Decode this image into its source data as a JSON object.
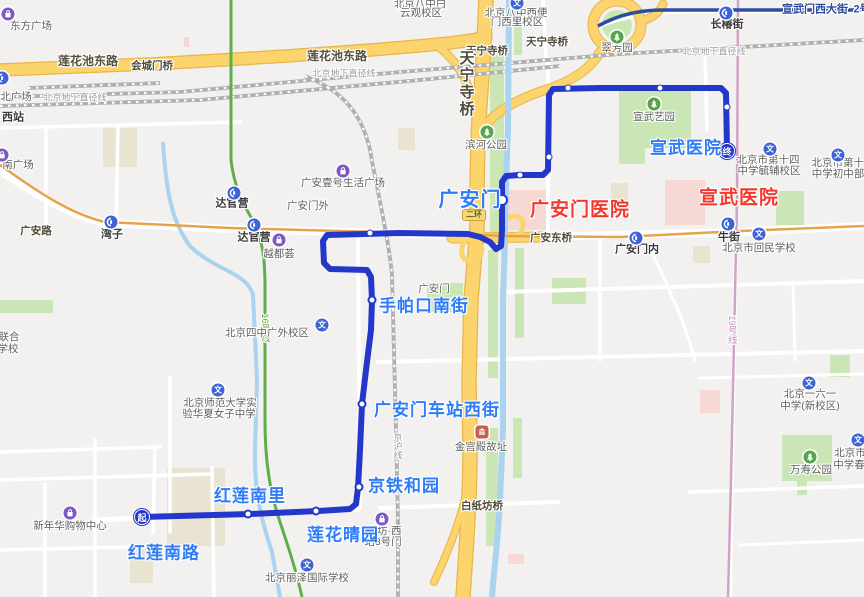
{
  "app": {
    "kind": "map-transit-route-view"
  },
  "colors": {
    "bg": "#f2f1ef",
    "route-blue": "#2337cb",
    "stop-blue": "#2e7cf6",
    "poi-red": "#f5382e",
    "road-yellow": "#fbd46d",
    "road-yellow-casing": "#e7b54a",
    "river-blue": "#a9d3ee",
    "park-green": "#c9e6b4",
    "metro-line2": "#2c4e9e",
    "metro-line7": "#e8a24c",
    "metro-line16": "#5fae49",
    "metro-line19": "#d0a2c6"
  },
  "route": {
    "start_badge": "起",
    "end_badge": "终",
    "points": [
      [
        142,
        517
      ],
      [
        250,
        514
      ],
      [
        318,
        511
      ],
      [
        350,
        509
      ],
      [
        356,
        504
      ],
      [
        358,
        488
      ],
      [
        360,
        450
      ],
      [
        362,
        404
      ],
      [
        366,
        370
      ],
      [
        371,
        330
      ],
      [
        372,
        300
      ],
      [
        371,
        277
      ],
      [
        367,
        270
      ],
      [
        330,
        269
      ],
      [
        324,
        263
      ],
      [
        323,
        241
      ],
      [
        327,
        235
      ],
      [
        400,
        233
      ],
      [
        468,
        234
      ],
      [
        480,
        237
      ],
      [
        490,
        242
      ],
      [
        496,
        249
      ],
      [
        501,
        246
      ],
      [
        502,
        230
      ],
      [
        502,
        182
      ],
      [
        506,
        176
      ],
      [
        519,
        175
      ],
      [
        543,
        175
      ],
      [
        548,
        170
      ],
      [
        549,
        95
      ],
      [
        553,
        89
      ],
      [
        600,
        88
      ],
      [
        660,
        88
      ],
      [
        721,
        88
      ],
      [
        726,
        93
      ],
      [
        727,
        150
      ]
    ],
    "stops": [
      {
        "name": "红莲南路",
        "kind": "start",
        "dot": [
          142,
          517
        ],
        "label": [
          164,
          553
        ]
      },
      {
        "name": "红莲南里",
        "kind": "mid",
        "dot": [
          248,
          514
        ],
        "label": [
          250,
          496
        ]
      },
      {
        "name": "莲花晴园",
        "kind": "mid",
        "dot": [
          316,
          511
        ],
        "label": [
          343,
          535
        ]
      },
      {
        "name": "京铁和园",
        "kind": "mid",
        "dot": [
          359,
          487
        ],
        "label": [
          404,
          486
        ]
      },
      {
        "name": "广安门车站西街",
        "kind": "mid",
        "dot": [
          362,
          404
        ],
        "label": [
          437,
          410
        ]
      },
      {
        "name": "手帕口南街",
        "kind": "mid",
        "dot": [
          372,
          300
        ],
        "label": [
          424,
          306
        ]
      },
      {
        "name": "广安门",
        "kind": "mid-big",
        "dot": [
          502,
          200
        ],
        "label": [
          470,
          200
        ]
      },
      {
        "name": "宣武医院",
        "kind": "end",
        "dot": [
          727,
          151
        ],
        "label": [
          686,
          148
        ]
      }
    ],
    "waypoint_dots": [
      [
        370,
        233
      ],
      [
        520,
        175
      ],
      [
        549,
        157
      ],
      [
        568,
        88
      ],
      [
        660,
        88
      ],
      [
        727,
        107
      ]
    ]
  },
  "shield": {
    "t": "二环"
  },
  "shield_pos": {
    "x": 474,
    "y": 215
  },
  "labels": [
    {
      "t": "广安门医院",
      "x": 580,
      "y": 210,
      "c": "red",
      "n": "hospital-label-guanganmen"
    },
    {
      "t": "宣武医院",
      "x": 739,
      "y": 198,
      "c": "red",
      "n": "hospital-label-xuanwu"
    },
    {
      "t": "莲花池东路",
      "x": 88,
      "y": 61,
      "c": "road",
      "n": "road-label"
    },
    {
      "t": "莲花池东路",
      "x": 337,
      "y": 56,
      "c": "road",
      "n": "road-label"
    },
    {
      "t": "会城门桥",
      "x": 152,
      "y": 66,
      "c": "roadsm",
      "n": "bridge-label"
    },
    {
      "t": "天宁寺桥",
      "x": 487,
      "y": 51,
      "c": "roadsm",
      "n": "bridge-label"
    },
    {
      "t": "天宁寺桥",
      "x": 547,
      "y": 42,
      "c": "roadsm",
      "n": "bridge-label"
    },
    {
      "t": "天宁寺桥",
      "x": 466,
      "y": 84,
      "c": "vroad",
      "n": "bridge-label-vertical"
    },
    {
      "t": "广安东桥",
      "x": 551,
      "y": 238,
      "c": "roadsm",
      "n": "bridge-label"
    },
    {
      "t": "白纸坊桥",
      "x": 482,
      "y": 506,
      "c": "roadsm",
      "n": "bridge-label"
    },
    {
      "t": "广安路",
      "x": 36,
      "y": 231,
      "c": "roadsm",
      "n": "road-label"
    },
    {
      "t": "宣武门西大街",
      "x": 815,
      "y": 10,
      "c": "l2",
      "n": "road-label"
    },
    {
      "t": "2号",
      "x": 862,
      "y": 10,
      "c": "l2",
      "n": "metro-line2-label-clipped"
    },
    {
      "t": "北京地下直径线",
      "x": 75,
      "y": 98,
      "c": "rail",
      "n": "railway-label"
    },
    {
      "t": "北京地下直径线",
      "x": 344,
      "y": 74,
      "c": "rail",
      "n": "railway-label"
    },
    {
      "t": "北京地下直径线",
      "x": 714,
      "y": 52,
      "c": "rail",
      "n": "railway-label"
    },
    {
      "t": "京沪线",
      "x": 397,
      "y": 446,
      "c": "vrail",
      "n": "railway-label"
    },
    {
      "t": "16号线",
      "x": 264,
      "y": 328,
      "c": "l16",
      "n": "metro-line16-label"
    },
    {
      "t": "19号线",
      "x": 731,
      "y": 330,
      "c": "l19",
      "n": "metro-line19-label"
    },
    {
      "t": "达官营",
      "x": 232,
      "y": 204,
      "c": "stn",
      "n": "metro-station-label"
    },
    {
      "t": "达官营",
      "x": 254,
      "y": 238,
      "c": "stn",
      "n": "metro-station-label"
    },
    {
      "t": "湾子",
      "x": 112,
      "y": 235,
      "c": "stn",
      "n": "metro-station-label"
    },
    {
      "t": "长椿街",
      "x": 727,
      "y": 25,
      "c": "stn",
      "n": "metro-station-label"
    },
    {
      "t": "牛街",
      "x": 729,
      "y": 238,
      "c": "stn",
      "n": "metro-station-label"
    },
    {
      "t": "广安门内",
      "x": 637,
      "y": 250,
      "c": "stn",
      "n": "metro-station-label"
    },
    {
      "t": "西站",
      "x": 13,
      "y": 118,
      "c": "stn",
      "n": "poi-label"
    },
    {
      "t": "东方广场",
      "x": 31,
      "y": 26,
      "c": "poi",
      "n": "poi-label"
    },
    {
      "t": "北广场",
      "x": 16,
      "y": 97,
      "c": "poi",
      "n": "poi-label"
    },
    {
      "t": "南广场",
      "x": 18,
      "y": 165,
      "c": "poi",
      "n": "poi-label"
    },
    {
      "t": "北京八中白",
      "x": 420,
      "y": 4,
      "c": "poi",
      "n": "poi-label"
    },
    {
      "t": "云观校区",
      "x": 421,
      "y": 13,
      "c": "poi",
      "n": "poi-label"
    },
    {
      "t": "北京八中西便",
      "x": 516,
      "y": 13,
      "c": "poi",
      "n": "poi-label"
    },
    {
      "t": "门西里校区",
      "x": 517,
      "y": 22,
      "c": "poi",
      "n": "poi-label"
    },
    {
      "t": "翠芳园",
      "x": 617,
      "y": 48,
      "c": "poi",
      "n": "poi-label"
    },
    {
      "t": "滨河公园",
      "x": 486,
      "y": 145,
      "c": "poi",
      "n": "poi-label"
    },
    {
      "t": "宣武艺园",
      "x": 654,
      "y": 117,
      "c": "poi",
      "n": "poi-label"
    },
    {
      "t": "广安壹号生活广场",
      "x": 343,
      "y": 183,
      "c": "poi",
      "n": "poi-label"
    },
    {
      "t": "广安门外",
      "x": 308,
      "y": 206,
      "c": "poi",
      "n": "area-label"
    },
    {
      "t": "越都荟",
      "x": 279,
      "y": 254,
      "c": "poi",
      "n": "poi-label"
    },
    {
      "t": "广安门",
      "x": 434,
      "y": 289,
      "c": "poi",
      "n": "area-label"
    },
    {
      "t": "北京四中广外校区",
      "x": 267,
      "y": 333,
      "c": "poi",
      "n": "poi-label"
    },
    {
      "t": "联合",
      "x": 9,
      "y": 337,
      "c": "poi",
      "n": "poi-label-clipped"
    },
    {
      "t": "学校",
      "x": 8,
      "y": 349,
      "c": "poi",
      "n": "poi-label-clipped"
    },
    {
      "t": "北京师范大学实",
      "x": 220,
      "y": 403,
      "c": "poi",
      "n": "poi-label"
    },
    {
      "t": "验华夏女子中学",
      "x": 219,
      "y": 414,
      "c": "poi",
      "n": "poi-label"
    },
    {
      "t": "新年华购物中心",
      "x": 70,
      "y": 526,
      "c": "poi",
      "n": "poi-label"
    },
    {
      "t": "北京丽泽国际学校",
      "x": 307,
      "y": 578,
      "c": "poi",
      "n": "poi-label"
    },
    {
      "t": "纸坊·西",
      "x": 384,
      "y": 531,
      "c": "poi",
      "n": "poi-label-partially-hidden"
    },
    {
      "t": "站3号门",
      "x": 383,
      "y": 542,
      "c": "poi",
      "n": "poi-label-partially-hidden"
    },
    {
      "t": "金宫殿故址",
      "x": 481,
      "y": 447,
      "c": "poi",
      "n": "poi-label"
    },
    {
      "t": "北京市回民学校",
      "x": 759,
      "y": 248,
      "c": "poi",
      "n": "poi-label"
    },
    {
      "t": "北京市第十四",
      "x": 768,
      "y": 160,
      "c": "poi",
      "n": "poi-label"
    },
    {
      "t": "中学毓辅校区",
      "x": 769,
      "y": 171,
      "c": "poi",
      "n": "poi-label"
    },
    {
      "t": "北京市第十四",
      "x": 843,
      "y": 163,
      "c": "poi",
      "n": "poi-label-clipped"
    },
    {
      "t": "中学初中部",
      "x": 838,
      "y": 174,
      "c": "poi",
      "n": "poi-label"
    },
    {
      "t": "北京一六一",
      "x": 810,
      "y": 394,
      "c": "poi",
      "n": "poi-label"
    },
    {
      "t": "中学(新校区)",
      "x": 810,
      "y": 406,
      "c": "poi",
      "n": "poi-label"
    },
    {
      "t": "北京市",
      "x": 850,
      "y": 453,
      "c": "poi",
      "n": "poi-label-clipped"
    },
    {
      "t": "中学春",
      "x": 849,
      "y": 465,
      "c": "poi",
      "n": "poi-label-clipped"
    },
    {
      "t": "万寿公园",
      "x": 811,
      "y": 470,
      "c": "poi",
      "n": "poi-label"
    }
  ],
  "icons": [
    {
      "type": "metro",
      "x": 2,
      "y": 78
    },
    {
      "type": "metro",
      "x": 234,
      "y": 193
    },
    {
      "type": "metro",
      "x": 254,
      "y": 225
    },
    {
      "type": "metro",
      "x": 111,
      "y": 222
    },
    {
      "type": "metro",
      "x": 726,
      "y": 13
    },
    {
      "type": "metro",
      "x": 728,
      "y": 224
    },
    {
      "type": "metro",
      "x": 636,
      "y": 238
    },
    {
      "type": "school",
      "x": 218,
      "y": 390
    },
    {
      "type": "school",
      "x": 307,
      "y": 565
    },
    {
      "type": "school",
      "x": 322,
      "y": 325
    },
    {
      "type": "school",
      "x": 770,
      "y": 149
    },
    {
      "type": "school",
      "x": 838,
      "y": 155
    },
    {
      "type": "school",
      "x": 809,
      "y": 383
    },
    {
      "type": "school",
      "x": 858,
      "y": 440
    },
    {
      "type": "school",
      "x": 759,
      "y": 234
    },
    {
      "type": "school",
      "x": 517,
      "y": 3
    },
    {
      "type": "park",
      "x": 617,
      "y": 37
    },
    {
      "type": "park",
      "x": 487,
      "y": 132
    },
    {
      "type": "park",
      "x": 654,
      "y": 104
    },
    {
      "type": "park",
      "x": 810,
      "y": 457
    },
    {
      "type": "shop",
      "x": 8,
      "y": 14
    },
    {
      "type": "shop",
      "x": 2,
      "y": 155
    },
    {
      "type": "shop",
      "x": 70,
      "y": 513
    },
    {
      "type": "shop",
      "x": 343,
      "y": 171
    },
    {
      "type": "shop",
      "x": 279,
      "y": 240
    },
    {
      "type": "shop",
      "x": 382,
      "y": 519
    },
    {
      "type": "landmark",
      "x": 482,
      "y": 432
    }
  ],
  "school_icon_glyph": "文"
}
